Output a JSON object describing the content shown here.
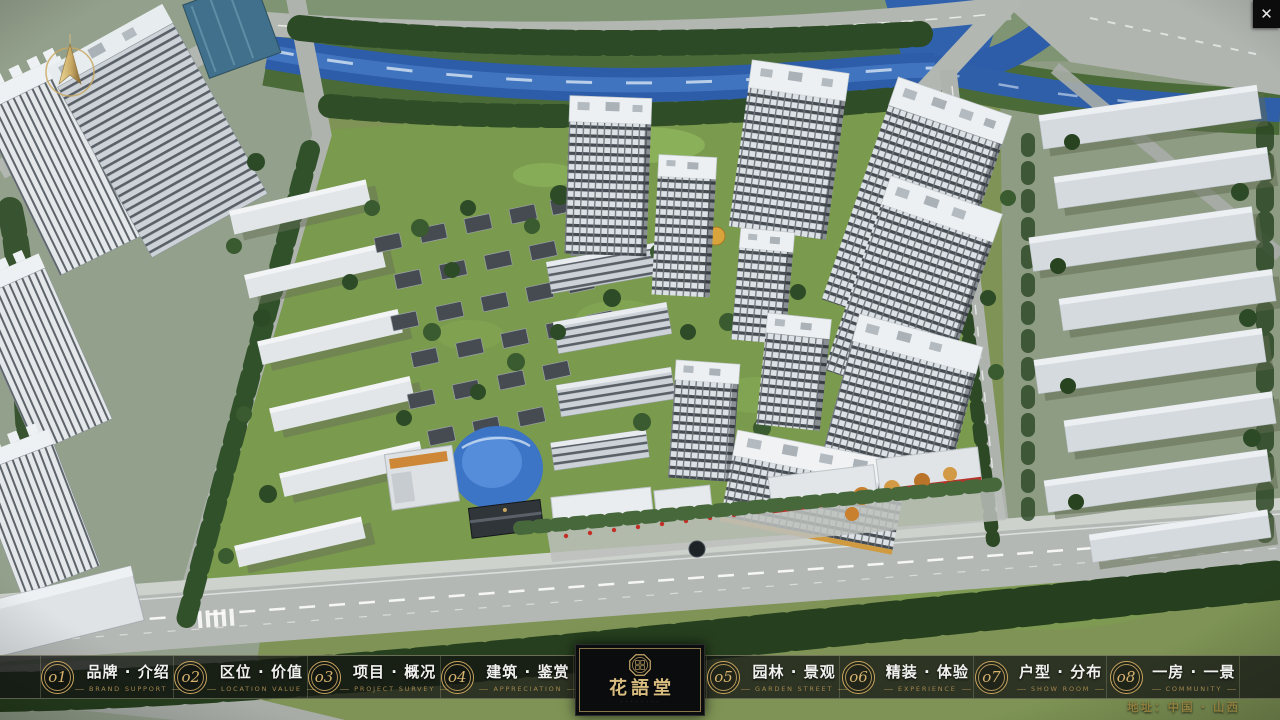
{
  "titlebar": {
    "close": "✕"
  },
  "logo": {
    "name": "花語堂",
    "subtext": "· · · · · · · ·"
  },
  "nav": {
    "items": [
      {
        "num": "o1",
        "cn": "品牌 · 介绍",
        "en": "BRAND SUPPORT"
      },
      {
        "num": "o2",
        "cn": "区位 · 价值",
        "en": "LOCATION VALUE"
      },
      {
        "num": "o3",
        "cn": "项目 · 概况",
        "en": "PROJECT SURVEY"
      },
      {
        "num": "o4",
        "cn": "建筑 · 鉴赏",
        "en": "APPRECIATION"
      },
      {
        "num": "o5",
        "cn": "园林 · 景观",
        "en": "GARDEN STREET"
      },
      {
        "num": "o6",
        "cn": "精装 · 体验",
        "en": "EXPERIENCE"
      },
      {
        "num": "o7",
        "cn": "户型 · 分布",
        "en": "SHOW ROOM"
      },
      {
        "num": "o8",
        "cn": "一房 · 一景",
        "en": "COMMUNITY"
      }
    ]
  },
  "footer": {
    "address": "地址：中国 · 山西"
  },
  "colors": {
    "accent_gold": "#c9a55e",
    "bar_bg": "rgba(20,22,20,0.76)",
    "river_blue": "#2d5ca8"
  }
}
